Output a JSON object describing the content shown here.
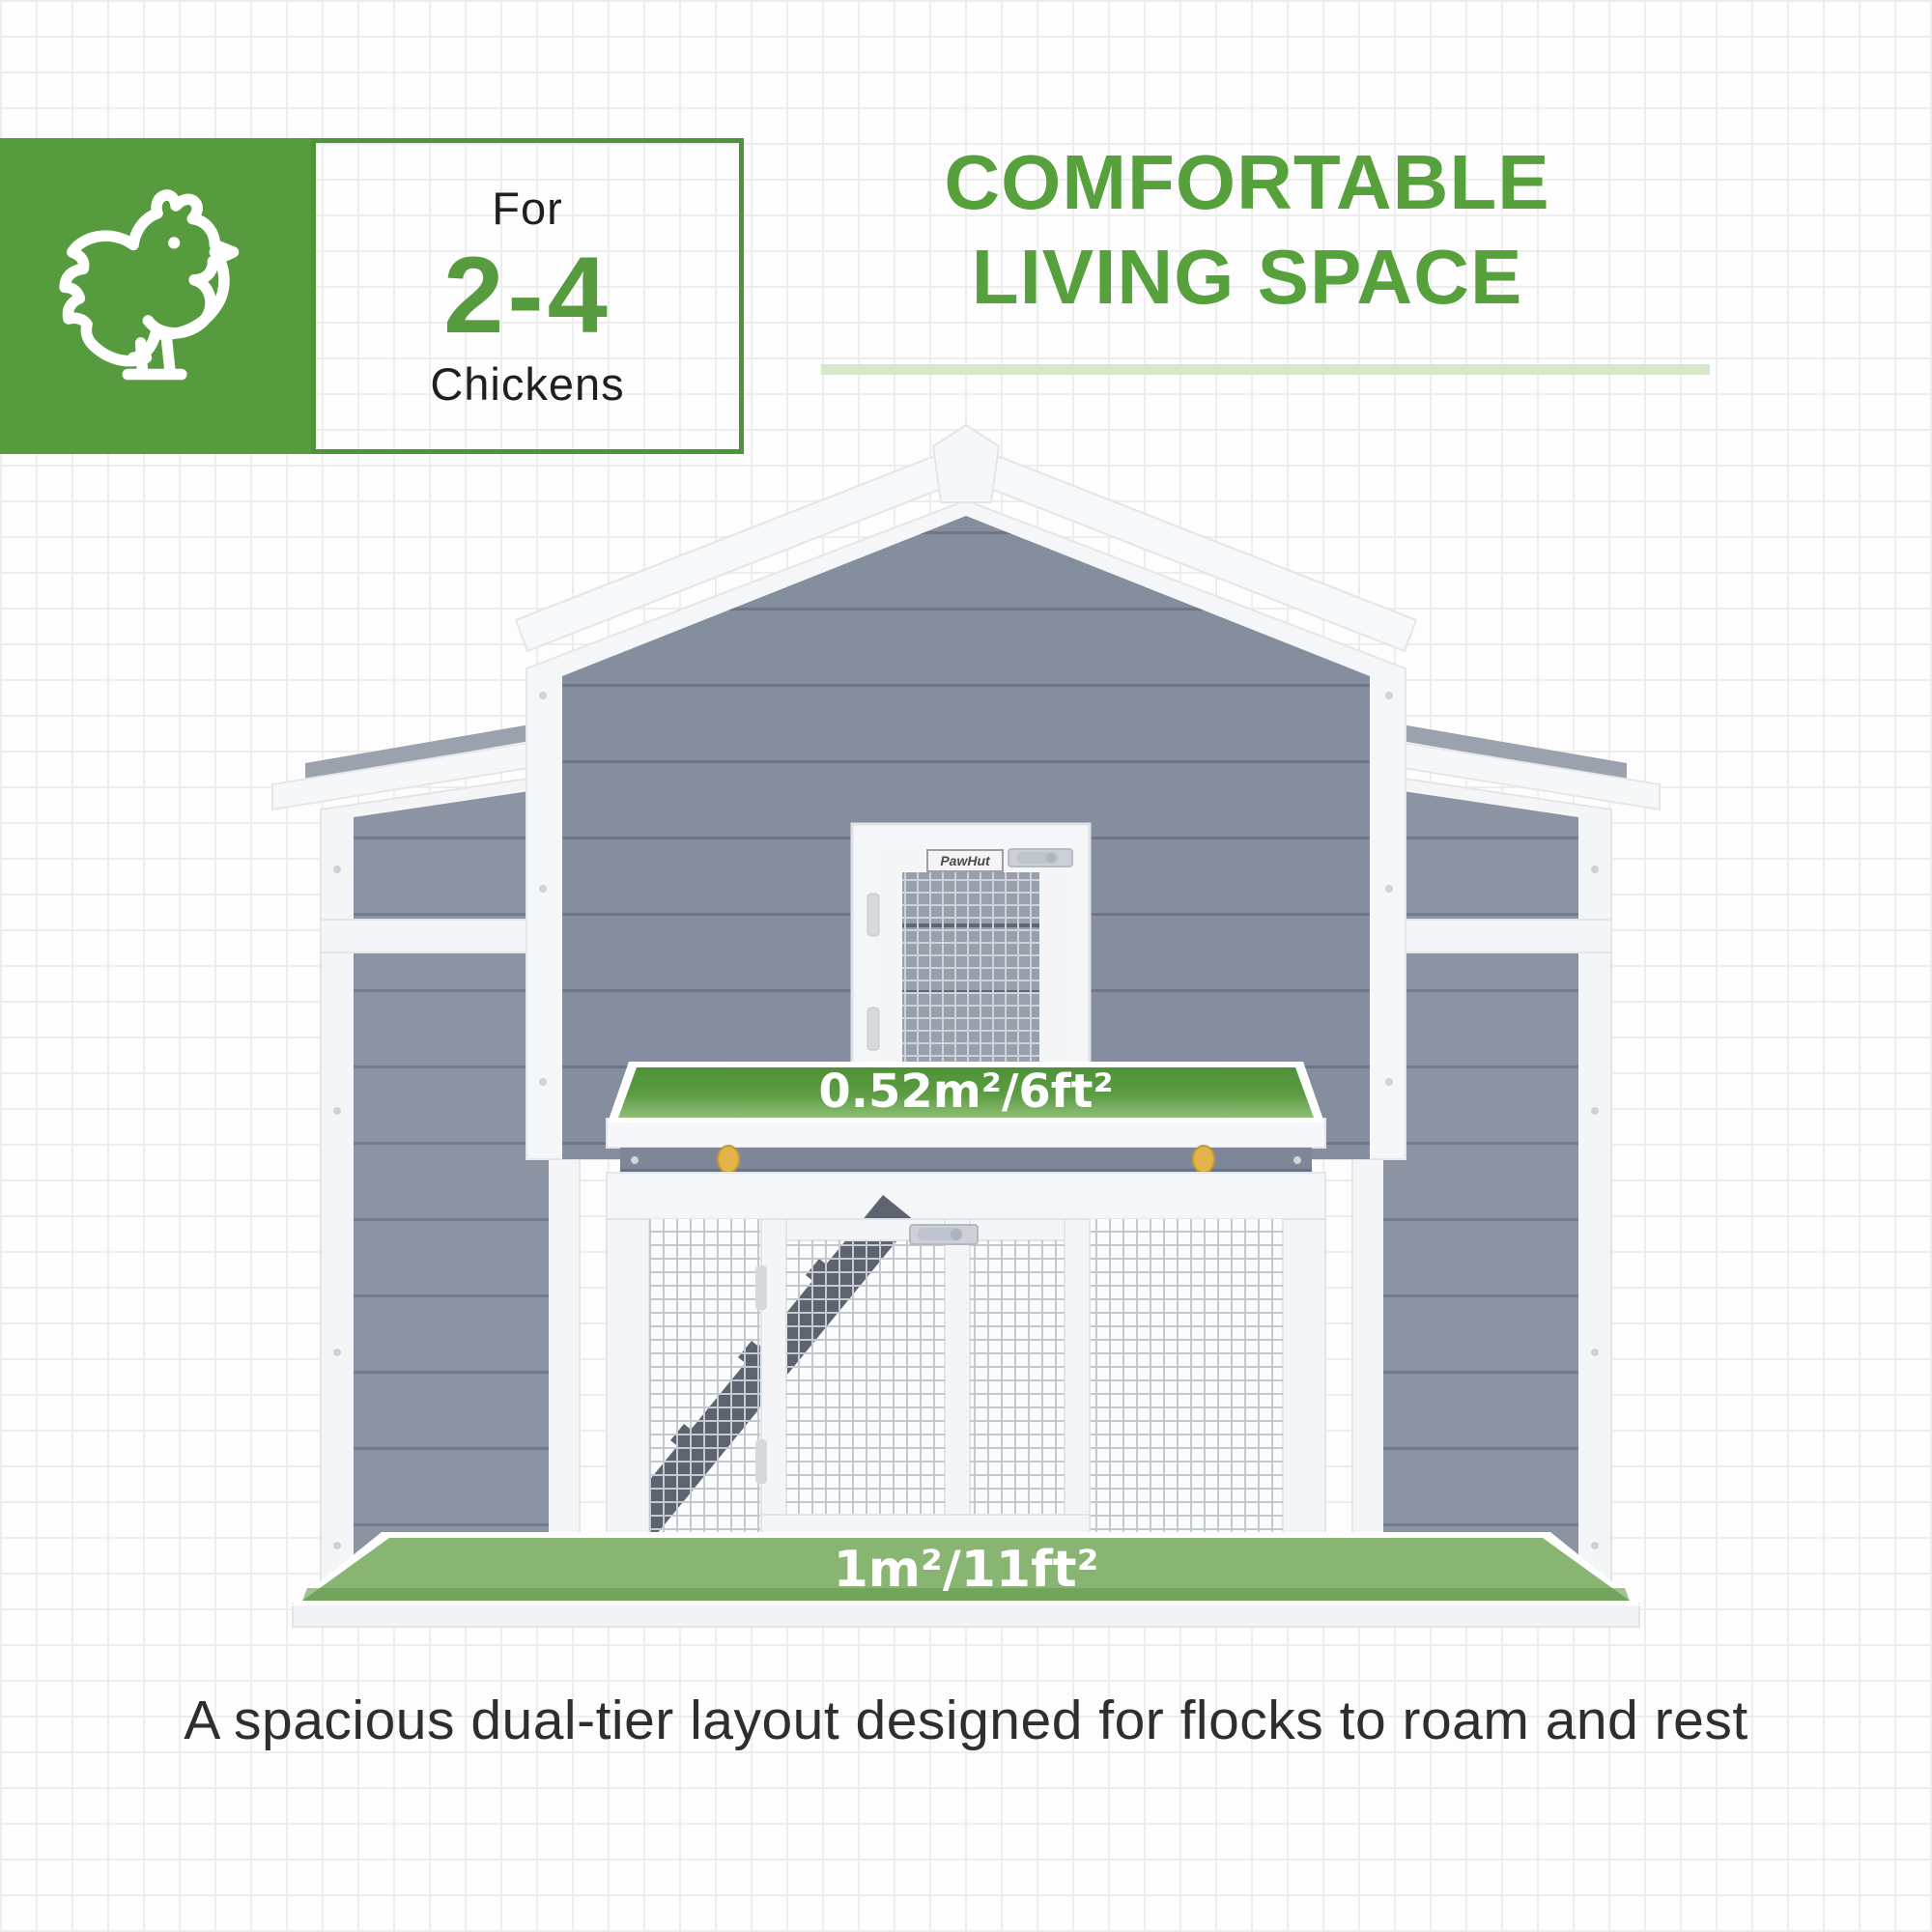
{
  "badge": {
    "line1": "For",
    "line2": "2-4",
    "line3": "Chickens"
  },
  "title": {
    "line1": "COMFORTABLE",
    "line2": "LIVING SPACE"
  },
  "coop": {
    "upper_area_label": "0.52m²/6ft²",
    "lower_area_label": "1m²/11ft²",
    "brand_plaque": "PawHut"
  },
  "caption": {
    "text": "A spacious dual-tier layout designed for flocks to roam and rest"
  },
  "icons": {
    "chicken": "chicken-outline-icon"
  },
  "colors": {
    "brand_green": "#569b3e",
    "title_green": "#56a13c",
    "border_green": "#4d9538",
    "underline_pale_green": "#d6e7ca",
    "platform_green_dark": "#4f9337",
    "platform_green_light": "#8fbe78",
    "floor_green": "#74a85a",
    "siding_gray_barn": "#858e9f",
    "siding_gray_wing": "#8c94a4",
    "white_wood": "#f5f6f8",
    "ramp_gray": "#5c636e",
    "knob_yellow": "#e3b44a",
    "caption_text": "#2e2e2e"
  }
}
